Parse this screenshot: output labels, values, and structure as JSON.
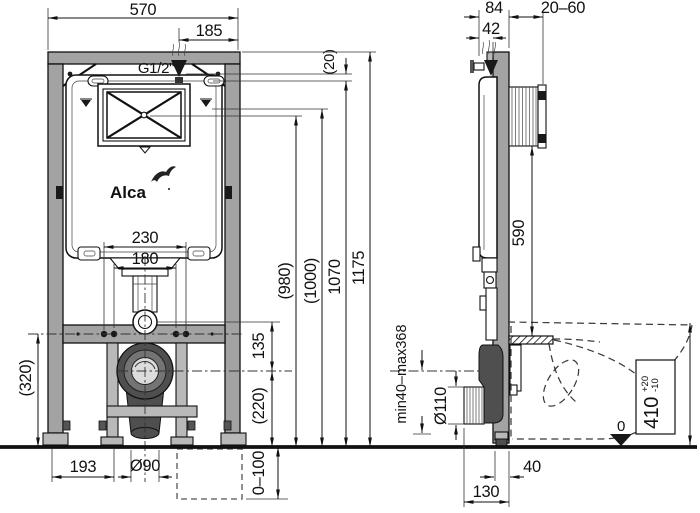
{
  "brand": {
    "logo_text": "Alca"
  },
  "colors": {
    "frame_gray": "#a3a3a3",
    "dark_fitting": "#4f4f4f",
    "line_black": "#111111",
    "background": "#ffffff"
  },
  "front_view": {
    "dims": {
      "overall_width": "570",
      "inlet_offset": "185",
      "water_inlet": "G1/2\"",
      "inlet_drop": "(20)",
      "bolt_spacing_outer": "230",
      "bolt_spacing_inner": "180",
      "height_flush_center": "(980)",
      "height_1000": "(1000)",
      "height_1070": "1070",
      "overall_height": "1175",
      "flush_to_drain": "135",
      "drain_height": "(220)",
      "crossbar_height": "(320)",
      "foot_spacing": "193",
      "drain_diameter": "Ø90",
      "leg_adjust": "0–100"
    }
  },
  "side_view": {
    "dims": {
      "frame_depth": "84",
      "inlet_depth": "42",
      "wall_finish_range": "20–60",
      "box_to_shelf": "590",
      "drain_range": "min40–max368",
      "outlet_diameter": "Ø110",
      "seat_height": "410",
      "seat_tol_plus": "+20",
      "seat_tol_minus": "-10",
      "floor_datum": "0",
      "profile_depth": "40",
      "outlet_offset": "130"
    }
  }
}
